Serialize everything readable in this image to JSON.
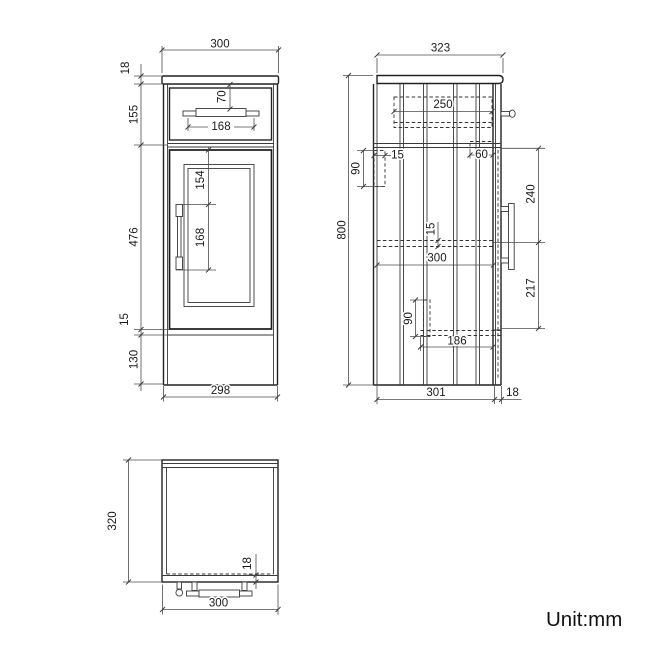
{
  "drawing": {
    "type": "cabinet-technical-drawing",
    "colors": {
      "ink": "#222222",
      "dim_line": "#4d4d4d",
      "background": "#ffffff"
    },
    "front": {
      "width_top": "300",
      "counter_thk": "18",
      "drawer_h": "155",
      "door_h": "476",
      "gap": "15",
      "plinth_h": "130",
      "width_bottom": "298",
      "handle_drop": "70",
      "handle_span": "168",
      "door_handle_drop": "154",
      "door_handle_span": "168"
    },
    "side": {
      "depth_top": "323",
      "height": "800",
      "drawer_depth": "250",
      "back_bracket_w": "15",
      "back_bracket_h": "90",
      "top_rail": "60",
      "handle_top": "240",
      "shelf_thk": "15",
      "shelf_depth": "300",
      "handle_bottom": "217",
      "front_bracket_h": "90",
      "bottom_rail": "186",
      "body_depth": "301",
      "door_thk": "18"
    },
    "plan": {
      "depth": "320",
      "door_thk": "18",
      "width": "300"
    },
    "note": {
      "unit": "Unit:mm"
    }
  }
}
